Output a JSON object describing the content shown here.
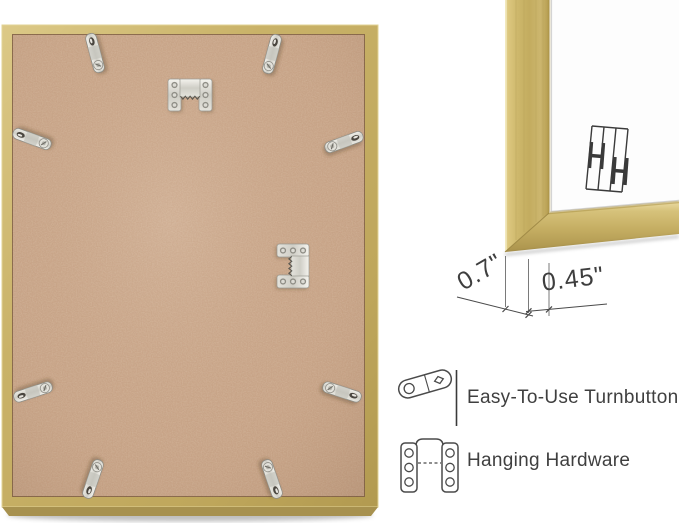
{
  "corner_detail": {
    "measurements": {
      "depth": "0.7\"",
      "face_width": "0.45\""
    }
  },
  "features": [
    {
      "icon": "turnbuttons-icon",
      "label": "Easy-To-Use Turnbuttons"
    },
    {
      "icon": "hanging-hardware-icon",
      "label": "Hanging Hardware"
    }
  ],
  "icons": {
    "corner_sketch": "sawtooth-hanger-sketch-icon",
    "back_hardware": "sawtooth-hanger",
    "back_clips": "turnbutton"
  },
  "colors": {
    "frame_gold": "#c9b268",
    "mdf_board": "#c7a286",
    "hardware_metal": "#d6d5cd",
    "annotation_line": "#4a4a4a",
    "label_text": "#3f3f3f",
    "background": "#ffffff"
  }
}
